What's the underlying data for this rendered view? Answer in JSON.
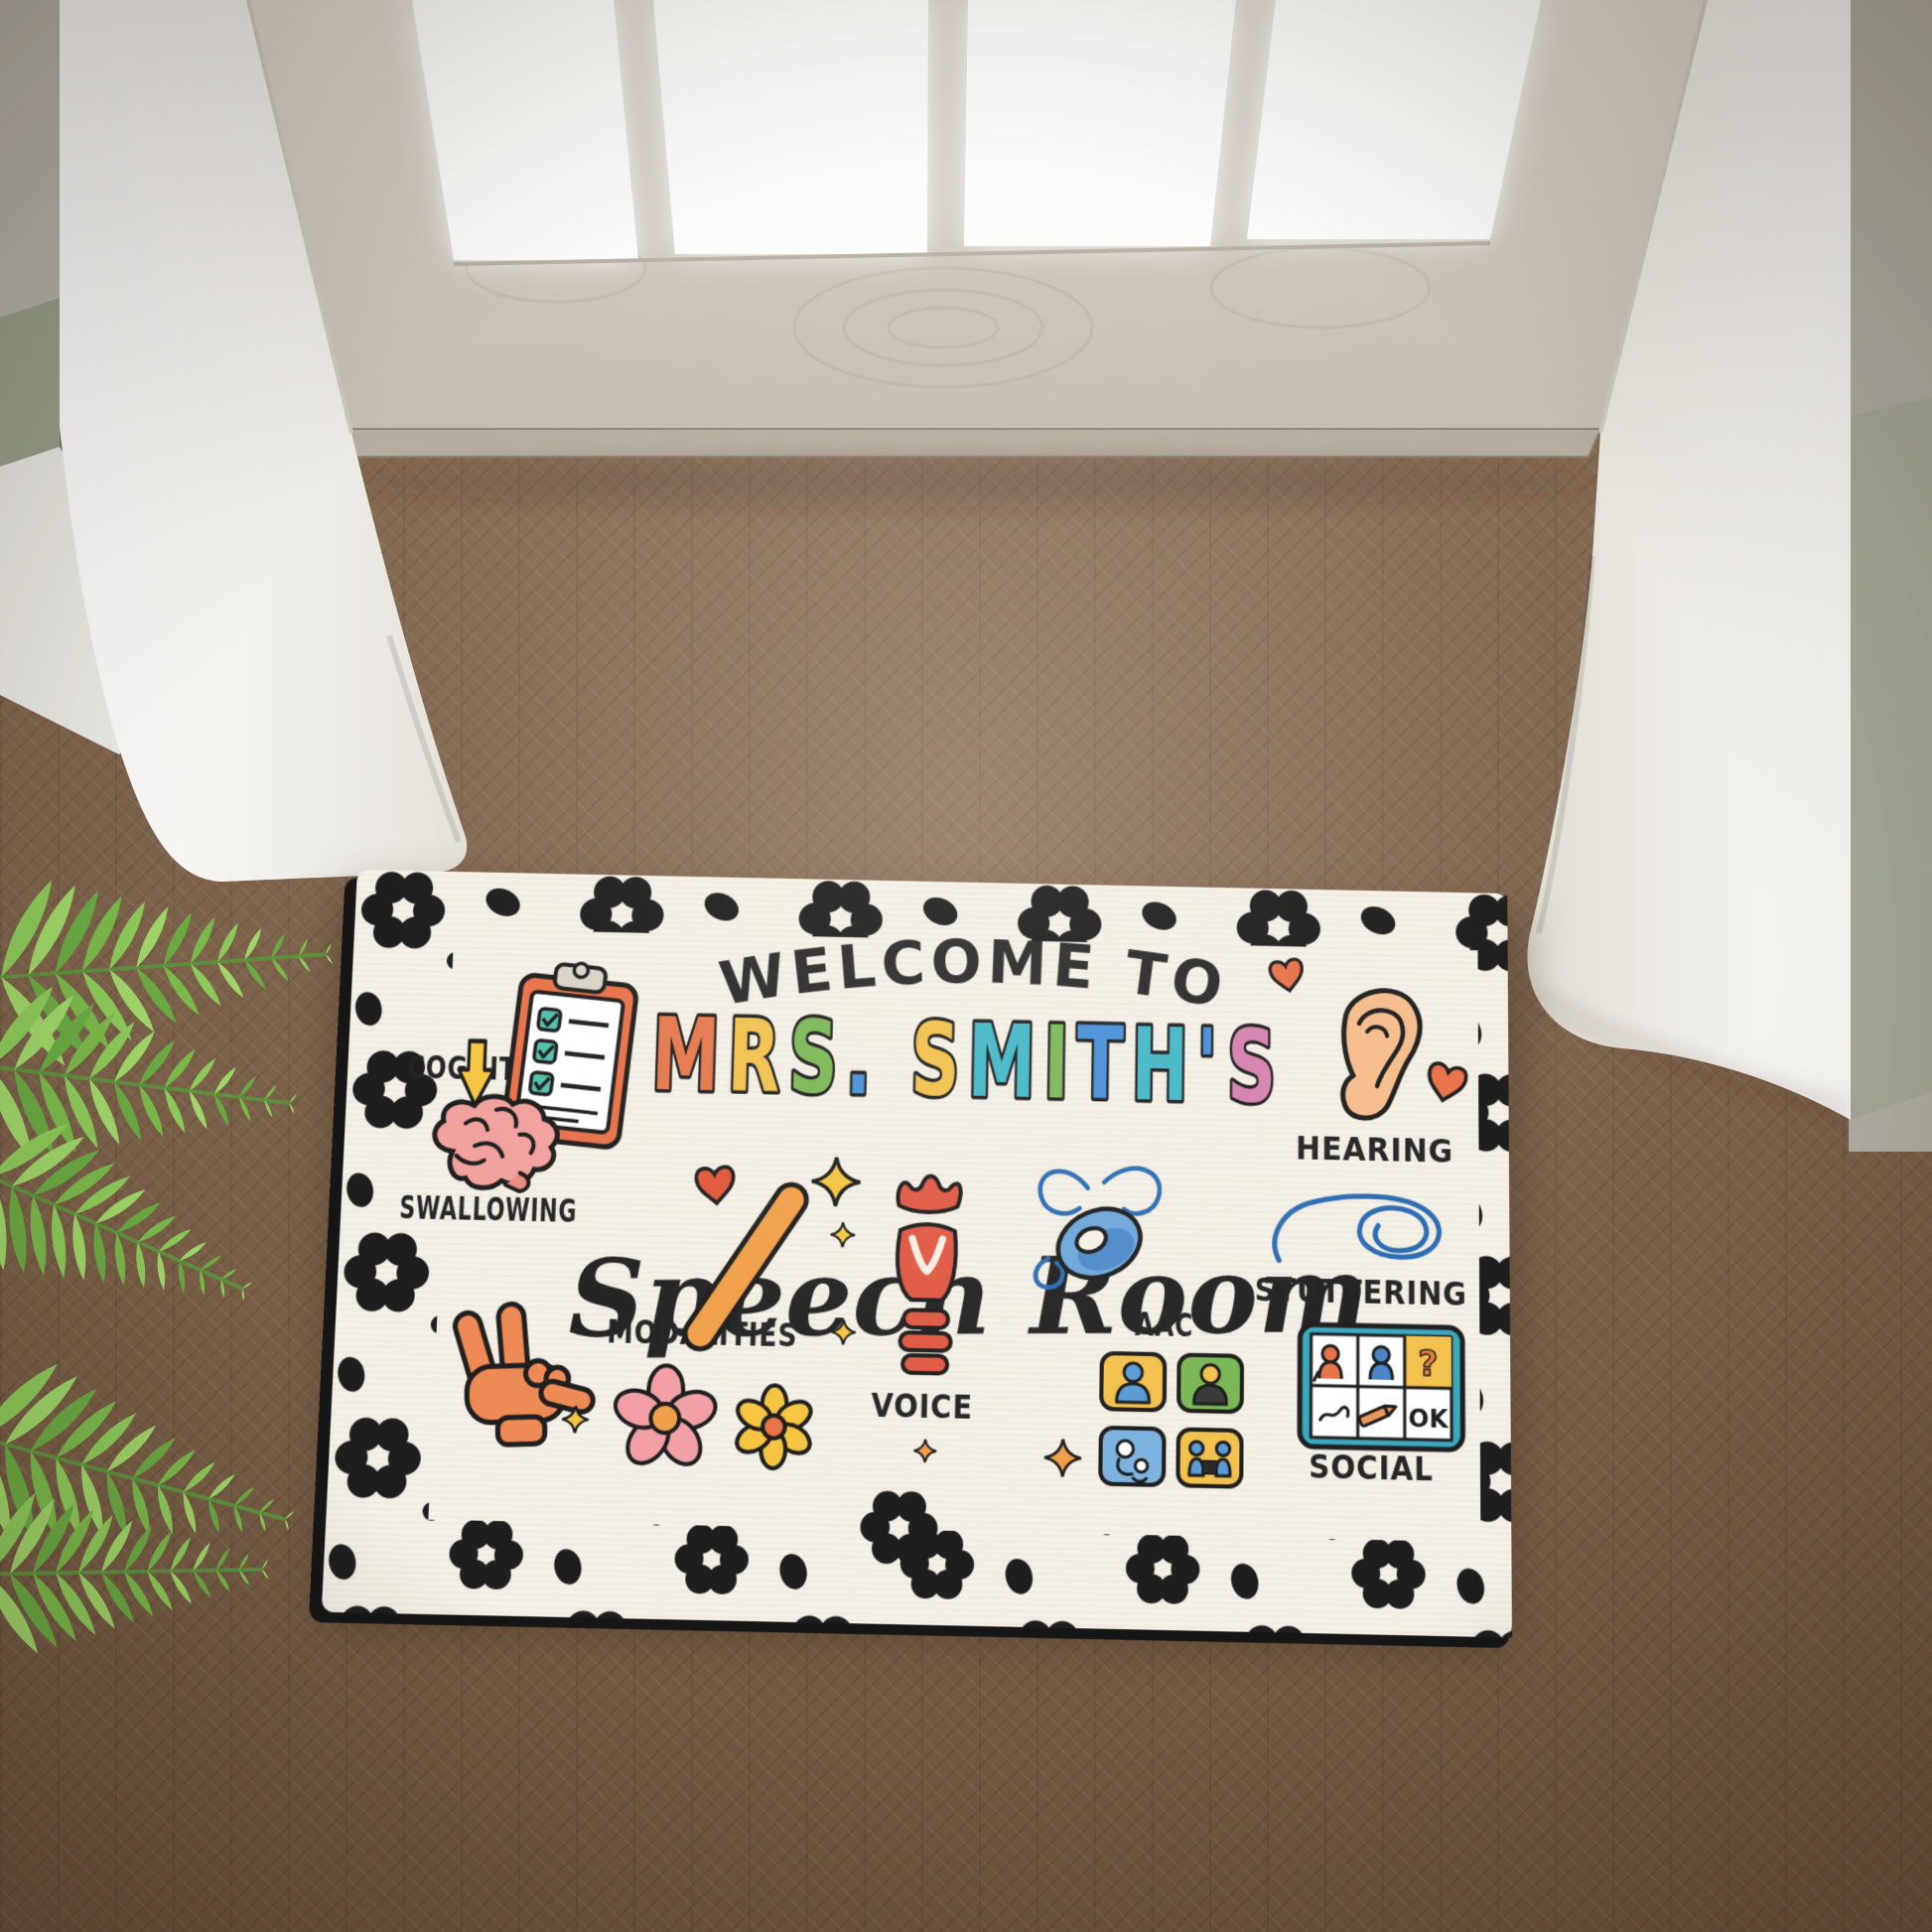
{
  "scene": {
    "colors": {
      "floor_wood": "#7f644c",
      "door_panel": "#d3ccc1",
      "glass_light": "#fbfcfa",
      "trim_white": "#f4f3ef",
      "wall_accent_green": "#99a18c",
      "fern_green": "#8cc95a"
    }
  },
  "mat": {
    "welcome_line": "WELCOME TO",
    "name_text": "MRS. SMITH'S",
    "name_letters": [
      {
        "ch": "M",
        "color": "#E5794E"
      },
      {
        "ch": "R",
        "color": "#F2C14E"
      },
      {
        "ch": "S",
        "color": "#7CB857"
      },
      {
        "ch": ".",
        "color": "#4A90D9"
      },
      {
        "ch": " ",
        "color": ""
      },
      {
        "ch": "S",
        "color": "#F2C14E"
      },
      {
        "ch": "M",
        "color": "#45B8C8"
      },
      {
        "ch": "I",
        "color": "#7CB857"
      },
      {
        "ch": "T",
        "color": "#4A90D9"
      },
      {
        "ch": "H",
        "color": "#45B8C8"
      },
      {
        "ch": "'",
        "color": "#4A90D9"
      },
      {
        "ch": "S",
        "color": "#D583B0"
      }
    ],
    "script_line": "Speech Room",
    "labels": [
      {
        "id": "cognition",
        "text": "COGNITION"
      },
      {
        "id": "hearing",
        "text": "HEARING"
      },
      {
        "id": "swallowing",
        "text": "SWALLOWING"
      },
      {
        "id": "modalities",
        "text": "MODALITIES"
      },
      {
        "id": "aac",
        "text": "AAC"
      },
      {
        "id": "stuttering",
        "text": "STUTTERING"
      },
      {
        "id": "voice",
        "text": "VOICE"
      },
      {
        "id": "social",
        "text": "SOCIAL"
      }
    ],
    "board": {
      "question_mark": "?",
      "ok_label": "OK"
    },
    "icon_names": [
      "clipboard-checklist-icon",
      "down-arrow-icon",
      "ear-icon",
      "heart-icon",
      "brain-icon",
      "ily-hand-icon",
      "popsicle-stick-icon",
      "sparkle-icon",
      "pink-flower-icon",
      "yellow-flower-icon",
      "larynx-icon",
      "hearing-aid-icon",
      "tangled-scribble-icon",
      "aac-tile-grid-icon",
      "communication-board-icon",
      "leopard-print-border"
    ],
    "colors": {
      "mat_base": "#f4f0e6",
      "spot_black": "#1e1e1e",
      "text_black": "#242424",
      "accent_orange": "#E8734A",
      "accent_yellow": "#F5C542",
      "accent_blue": "#2E6DB4",
      "accent_teal": "#3BAABF",
      "accent_pink": "#F2A0A5"
    }
  }
}
